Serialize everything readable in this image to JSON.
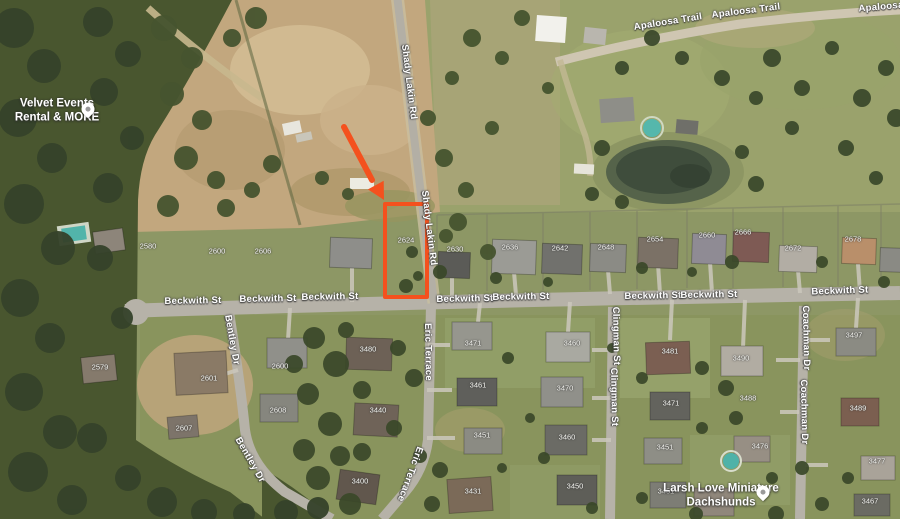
{
  "pois": {
    "velvet": {
      "line1": "Velvet Events",
      "line2": "Rental & MORE"
    },
    "larsh": {
      "line1": "Larsh Love Miniature",
      "line2": "Dachshunds"
    }
  },
  "streets": {
    "apaloosa": "Apaloosa Trail",
    "beckwith": "Beckwith St",
    "shady": "Shady Lakin Rd",
    "bentley": "Bentley Dr",
    "eric": "Eric Terrace",
    "clingman": "Clingman St",
    "coachman": "Coachman Dr"
  },
  "annotation": {
    "highlight_color": "#f4511e",
    "highlighted_lot": "2624"
  },
  "house_numbers": {
    "n2580": "2580",
    "n2600": "2600",
    "n2606": "2606",
    "n2624": "2624",
    "n2630": "2630",
    "n2636": "2636",
    "n2642": "2642",
    "n2648": "2648",
    "n2654": "2654",
    "n2660": "2660",
    "n2666": "2666",
    "n2672": "2672",
    "n2678": "2678",
    "w2579": "2579",
    "w2601": "2601",
    "w2607": "2607",
    "w2600": "2600",
    "w2608": "2608",
    "s3480": "3480",
    "s3471a": "3471",
    "s3460a": "3460",
    "s3481": "3481",
    "s3490": "3490",
    "s3497": "3497",
    "s3461": "3461",
    "s3470": "3470",
    "s3471b": "3471",
    "s3488": "3488",
    "s3489": "3489",
    "s3440": "3440",
    "s3451a": "3451",
    "s3460b": "3460",
    "s3451b": "3451",
    "s3476": "3476",
    "s3477": "3477",
    "s3400": "3400",
    "s3431": "3431",
    "s3450": "3450",
    "s3451c": "3451",
    "s3467": "3467"
  }
}
